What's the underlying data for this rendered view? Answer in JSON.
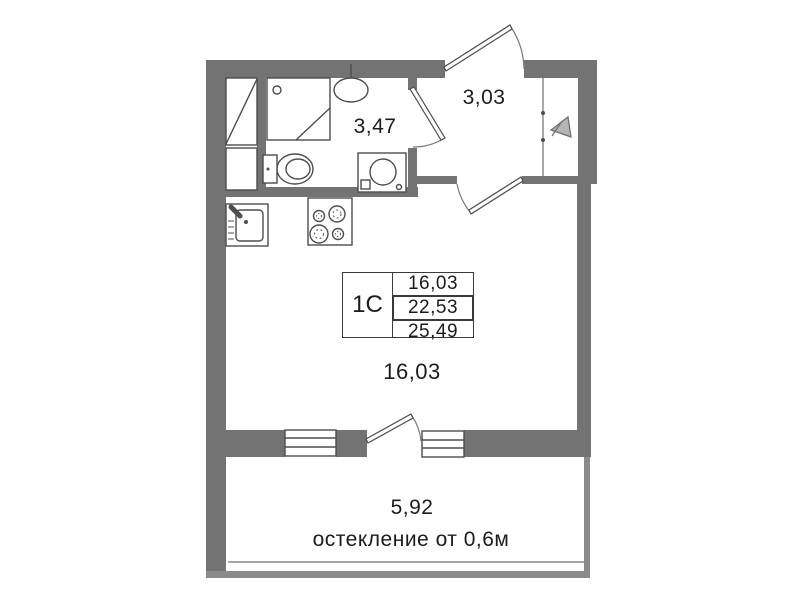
{
  "plan": {
    "unit_table": {
      "unit_label": "1C",
      "rows": [
        "16,03",
        "22,53",
        "25,49"
      ]
    },
    "areas": {
      "bathroom": "3,47",
      "hall": "3,03",
      "room": "16,03",
      "balcony": "5,92"
    },
    "glazing_note": "остекление от 0,6м",
    "fixtures": [
      "wardrobe-icon",
      "shower-cabin-icon",
      "bath-sink-icon",
      "toilet-icon",
      "washing-machine-icon",
      "kitchen-sink-icon",
      "stove-icon",
      "entrance-arrow-icon",
      "door-swing",
      "window"
    ]
  },
  "colors": {
    "wall": "#737373",
    "line": "#4d4d4d",
    "balcony_line": "#8a8a8a",
    "text": "#1c1c1c"
  }
}
